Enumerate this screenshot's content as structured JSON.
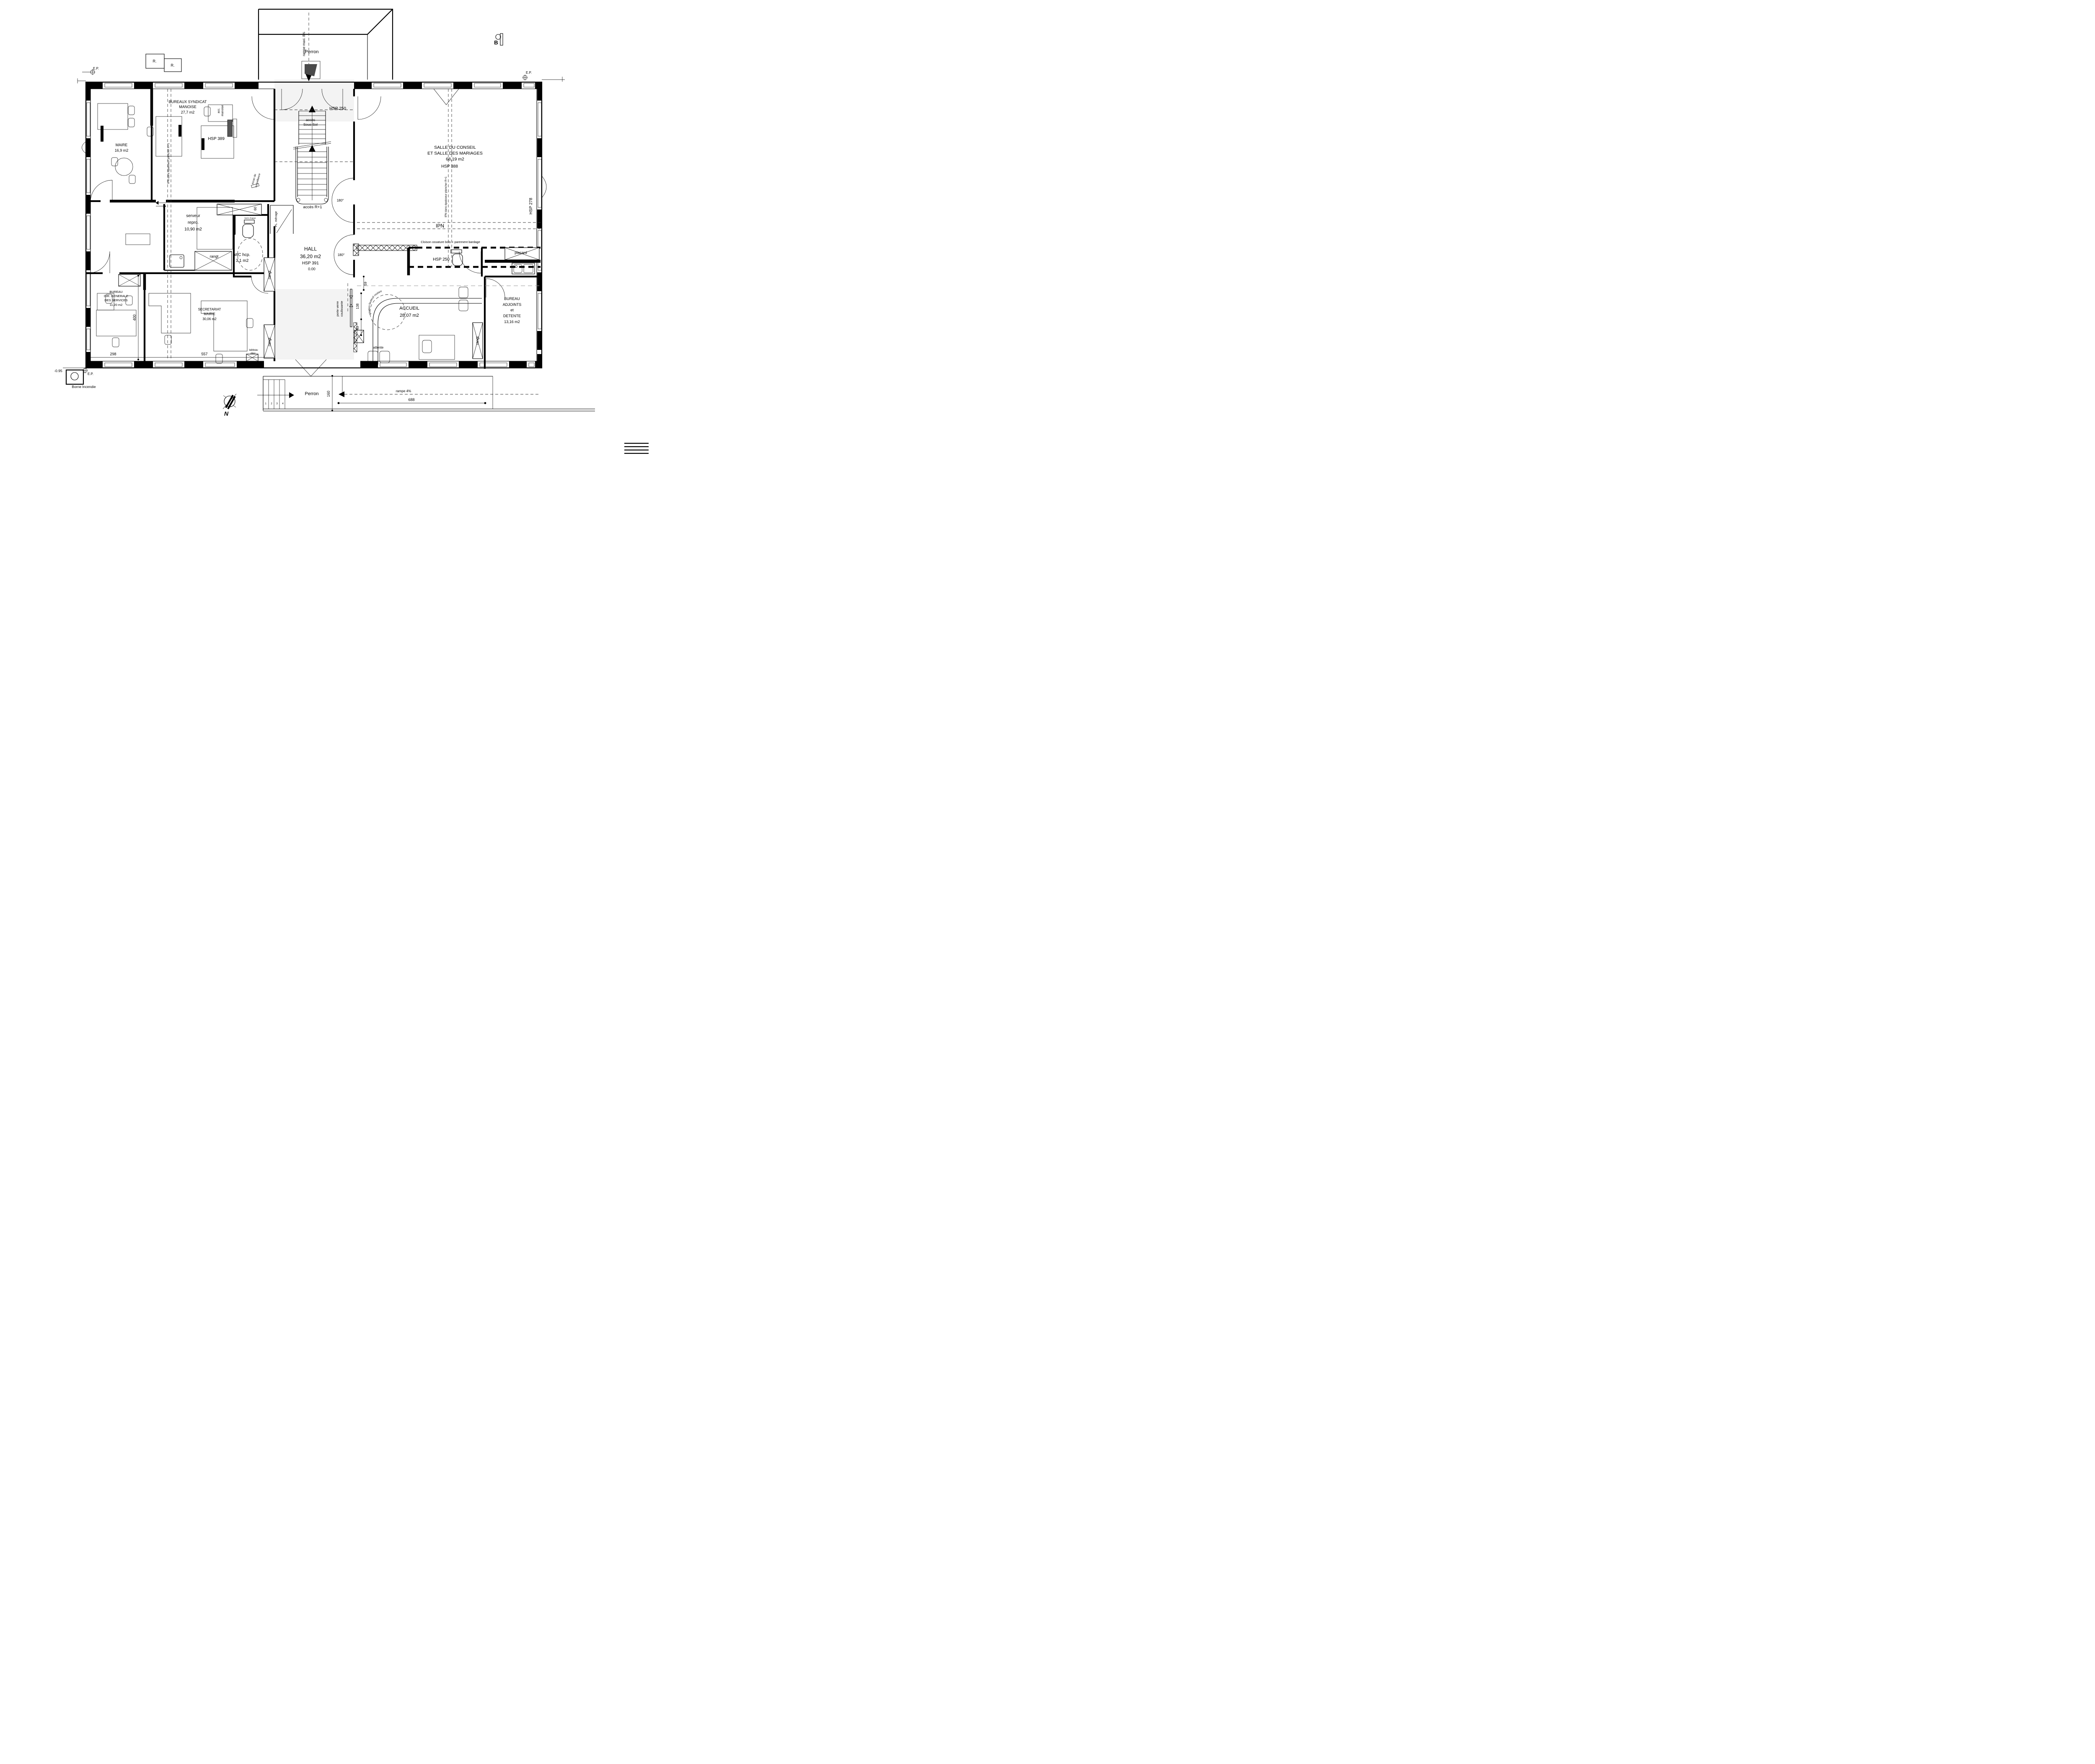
{
  "colors": {
    "ink": "#000000",
    "shade": "#f3f3f3",
    "dash_gray": "#9a9a9a"
  },
  "rooms": {
    "maire": {
      "lines": [
        "MAIRE",
        "16,9 m2"
      ]
    },
    "syndicat": {
      "lines": [
        "BUREAUX SYNDICAT",
        "MANOISE",
        "27,7 m2"
      ]
    },
    "salle": {
      "lines": [
        "SALLE DU CONSEIL",
        "ET SALLE DES MARIAGES",
        "68,19 m2"
      ],
      "hsp": "HSP 388"
    },
    "hall": {
      "lines": [
        "HALL",
        "36,20 m2"
      ],
      "hsp": "HSP 391",
      "level": "0.00"
    },
    "serveur": {
      "lines": [
        "serveur",
        "repro.",
        "10,90 m2"
      ]
    },
    "wc_hcp": {
      "lines": [
        "WC hcp.",
        "3,1 m2"
      ]
    },
    "dgs": {
      "lines": [
        "BUREAU",
        "DIR. GENERALE",
        "DES SERVICES",
        "11,20 m2"
      ]
    },
    "secretariat": {
      "lines": [
        "SECRETARIAT",
        "MAIRIE",
        "30,06 m2"
      ]
    },
    "accueil": {
      "lines": [
        "ACCUEIL",
        "28,07 m2"
      ]
    },
    "adjoints": {
      "lines": [
        "BUREAU",
        "ADJOINTS",
        "et",
        "DETENTE",
        "13,16 m2"
      ]
    }
  },
  "labels": {
    "perron_top": "Perron",
    "perron_bottom": "Perron",
    "rampe_maxi": "rampe maxi. 8%",
    "rampe4": "rampe 4%",
    "hsp389": "HSP 389",
    "hsp250_top": "HSP 250",
    "hsp250_wc": "HSP 250",
    "hsp278": "HSP 278",
    "ipn": "IPN",
    "ipn_note_left": "IPN dans épaisseur plancher R+1",
    "ipn_note_right": "IPN dans épaisseur plancher R+1",
    "cloison": "Cloison ossature bois + parement bardage",
    "placard": "placard",
    "acces_ss_1": "accès",
    "acces_ss_2": "Sous Sol",
    "acces_r1": "accès R+1",
    "deg180_a": "180°",
    "deg180_b": "180°",
    "porte_verre_1": "porte verre",
    "porte_verre_2": "coulissante",
    "ecran_1": "écran de",
    "ecran_2": "surveillance",
    "pl_menage": "PL. ménage",
    "barre_appui": "barre d'appui",
    "giration": "giration fauteuil roulant",
    "attente": "attente",
    "rangt_a": "rangt",
    "rangt_b": "rangt",
    "rangt_c": "rangt",
    "rangt_d": "rangt",
    "tableau_1": "tableau",
    "tableau_2": "élec.",
    "acc_manoise_1": "acc.",
    "acc_manoise_2": "manoise",
    "borne": "Borne Incendie",
    "ep": "E.P.",
    "ep2": "E.P.",
    "ep3": "E.P.",
    "r1": "R.",
    "r2": "R.",
    "b": "B",
    "north": "N"
  },
  "dims": {
    "d400": "400",
    "d298": "298",
    "d557": "557",
    "d688": "688",
    "d160": "160",
    "d59": "59",
    "d138": "138",
    "d43": "43",
    "d60": "60",
    "level": "-0.95",
    "steps": [
      "1",
      "2",
      "3",
      "4"
    ]
  }
}
